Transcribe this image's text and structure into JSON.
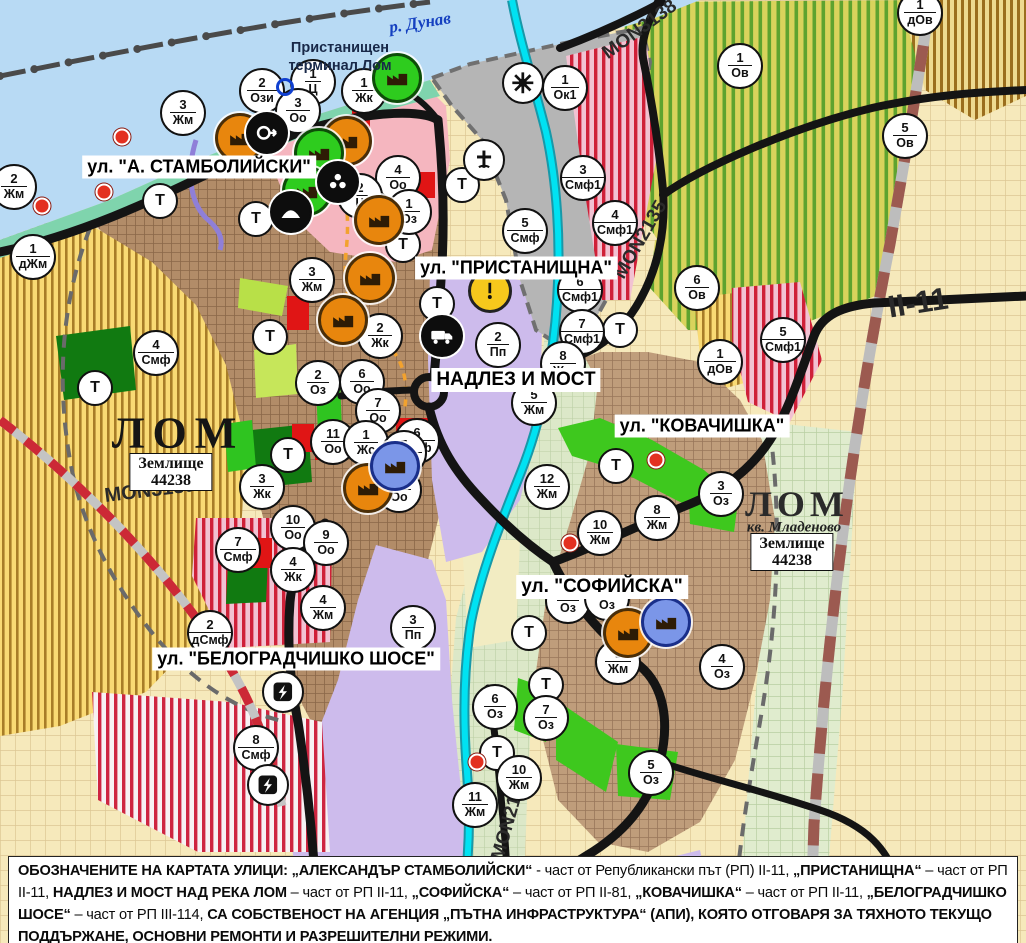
{
  "map": {
    "width": 1026,
    "height": 943,
    "colors": {
      "water": "#b8daf4",
      "shore": "#7fd4ad",
      "port_gray": "#b5b5b5",
      "urban_west": "#b28c68",
      "urban_east": "#bf9d7b",
      "pink_center": "#f5b6bf",
      "purple_zone": "#cdbbec",
      "yellow_farm": "#f9da74",
      "olive_orchard": "#d9d35c",
      "red_stripe": "#ce2540",
      "bright_green": "#3ec81e",
      "dark_green": "#117a11",
      "river_lom": "#00e2f2",
      "road_black": "#141414",
      "red_dash_road": "#cc2936",
      "brown_dash_road": "#9c5a50",
      "danube_label_blue": "#1540c0"
    },
    "street_labels": [
      {
        "text": "ул. \"А. СТАМБОЛИЙСКИ\"",
        "x": 199,
        "y": 167,
        "size": 18
      },
      {
        "text": "ул. \"ПРИСТАНИЩНА\"",
        "x": 516,
        "y": 268,
        "size": 18
      },
      {
        "text": "НАДЛЕЗ И МОСТ",
        "x": 516,
        "y": 380,
        "size": 19
      },
      {
        "text": "ул. \"КОВАЧИШКА\"",
        "x": 702,
        "y": 426,
        "size": 18
      },
      {
        "text": "ул. \"СОФИЙСКА\"",
        "x": 602,
        "y": 587,
        "size": 19
      },
      {
        "text": "ул. \"БЕЛОГРАДЧИШКО ШОСЕ\"",
        "x": 296,
        "y": 659,
        "size": 18
      }
    ],
    "road_labels": [
      {
        "text": "MON3138",
        "x": 640,
        "y": 30,
        "rot": -36,
        "size": 19
      },
      {
        "text": "MON2135",
        "x": 641,
        "y": 240,
        "rot": -60,
        "size": 19
      },
      {
        "text": "MON3139",
        "x": 150,
        "y": 491,
        "rot": -7,
        "size": 20
      },
      {
        "text": "MON2136",
        "x": 510,
        "y": 818,
        "rot": -74,
        "size": 19
      },
      {
        "text": "II-11",
        "x": 918,
        "y": 303,
        "rot": -9,
        "size": 31
      }
    ],
    "place_labels": {
      "danube": {
        "text": "р. Дунав"
      },
      "terminal": {
        "line1": "Пристанищен",
        "line2": "терминал Лом"
      },
      "lom_west": {
        "text": "ЛОМ"
      },
      "lom_east": {
        "text": "ЛОМ"
      },
      "mladenovo": {
        "text": "кв. Младеново"
      },
      "zemlishte_west": {
        "line1": "Землище",
        "line2": "44238"
      },
      "zemlishte_east": {
        "line1": "Землище",
        "line2": "44238"
      }
    },
    "t_label": "Т",
    "zone_markers": [
      {
        "n": "2",
        "c": "Жм",
        "x": 14,
        "y": 187
      },
      {
        "n": "3",
        "c": "Жм",
        "x": 183,
        "y": 113
      },
      {
        "n": "2",
        "c": "Ози",
        "x": 262,
        "y": 91
      },
      {
        "n": "1",
        "c": "Ц",
        "x": 313,
        "y": 82
      },
      {
        "n": "3",
        "c": "Оо",
        "x": 298,
        "y": 111
      },
      {
        "n": "1",
        "c": "Жк",
        "x": 364,
        "y": 91
      },
      {
        "n": "4",
        "c": "Оо",
        "x": 398,
        "y": 178
      },
      {
        "n": "2",
        "c": "Ц",
        "x": 360,
        "y": 196
      },
      {
        "n": "1",
        "c": "Оз",
        "x": 409,
        "y": 212
      },
      {
        "n": "1",
        "c": "Ок1",
        "x": 565,
        "y": 88
      },
      {
        "n": "1",
        "c": "дОв",
        "x": 920,
        "y": 13
      },
      {
        "n": "1",
        "c": "Ов",
        "x": 740,
        "y": 66
      },
      {
        "n": "5",
        "c": "Ов",
        "x": 905,
        "y": 136
      },
      {
        "n": "3",
        "c": "Смф1",
        "x": 583,
        "y": 178
      },
      {
        "n": "4",
        "c": "Смф1",
        "x": 615,
        "y": 223
      },
      {
        "n": "5",
        "c": "Смф",
        "x": 525,
        "y": 231
      },
      {
        "n": "6",
        "c": "Смф1",
        "x": 580,
        "y": 290
      },
      {
        "n": "7",
        "c": "Смф1",
        "x": 582,
        "y": 332
      },
      {
        "n": "2",
        "c": "Пп",
        "x": 498,
        "y": 345
      },
      {
        "n": "8",
        "c": "Жм",
        "x": 563,
        "y": 364
      },
      {
        "n": "5",
        "c": "Жм",
        "x": 534,
        "y": 403
      },
      {
        "n": "6",
        "c": "Ов",
        "x": 697,
        "y": 288
      },
      {
        "n": "1",
        "c": "дОв",
        "x": 720,
        "y": 362
      },
      {
        "n": "5",
        "c": "Смф1",
        "x": 783,
        "y": 340
      },
      {
        "n": "3",
        "c": "Оз",
        "x": 721,
        "y": 494
      },
      {
        "n": "8",
        "c": "Жм",
        "x": 657,
        "y": 518
      },
      {
        "n": "12",
        "c": "Жм",
        "x": 547,
        "y": 487
      },
      {
        "n": "10",
        "c": "Жм",
        "x": 600,
        "y": 533
      },
      {
        "n": "9",
        "c": "Жм",
        "x": 618,
        "y": 662
      },
      {
        "n": "4",
        "c": "Оз",
        "x": 722,
        "y": 667
      },
      {
        "n": "6",
        "c": "Оз",
        "x": 495,
        "y": 707
      },
      {
        "n": "7",
        "c": "Оз",
        "x": 546,
        "y": 718
      },
      {
        "n": "5",
        "c": "Оз",
        "x": 651,
        "y": 773
      },
      {
        "n": "10",
        "c": "Жм",
        "x": 519,
        "y": 778
      },
      {
        "n": "11",
        "c": "Жм",
        "x": 475,
        "y": 805
      },
      {
        "n": "8",
        "c": "Смф",
        "x": 256,
        "y": 748
      },
      {
        "n": "2",
        "c": "дСмф",
        "x": 210,
        "y": 633
      },
      {
        "n": "7",
        "c": "Смф",
        "x": 238,
        "y": 550
      },
      {
        "n": "10",
        "c": "Оо",
        "x": 293,
        "y": 528
      },
      {
        "n": "9",
        "c": "Оо",
        "x": 326,
        "y": 543
      },
      {
        "n": "4",
        "c": "Жк",
        "x": 293,
        "y": 570
      },
      {
        "n": "4",
        "c": "Жм",
        "x": 323,
        "y": 608
      },
      {
        "n": "3",
        "c": "Пп",
        "x": 413,
        "y": 628
      },
      {
        "n": "3",
        "c": "Жм",
        "x": 312,
        "y": 280
      },
      {
        "n": "2",
        "c": "Жк",
        "x": 380,
        "y": 336
      },
      {
        "n": "6",
        "c": "Оо",
        "x": 362,
        "y": 382
      },
      {
        "n": "7",
        "c": "Оо",
        "x": 378,
        "y": 411
      },
      {
        "n": "2",
        "c": "Оз",
        "x": 318,
        "y": 383
      },
      {
        "n": "11",
        "c": "Оо",
        "x": 333,
        "y": 442
      },
      {
        "n": "1",
        "c": "Жс",
        "x": 366,
        "y": 443
      },
      {
        "n": "6",
        "c": "Смф",
        "x": 417,
        "y": 441
      },
      {
        "n": "5",
        "c": "Смф",
        "x": 404,
        "y": 453
      },
      {
        "n": "8",
        "c": "Оо",
        "x": 399,
        "y": 490
      },
      {
        "n": "3",
        "c": "Жк",
        "x": 262,
        "y": 487
      },
      {
        "n": "1",
        "c": "дЖм",
        "x": 33,
        "y": 257
      },
      {
        "n": "4",
        "c": "Смф",
        "x": 156,
        "y": 353
      },
      {
        "n": "",
        "c": "Оз",
        "x": 568,
        "y": 601
      },
      {
        "n": "",
        "c": "Оз",
        "x": 607,
        "y": 598
      }
    ],
    "t_markers": [
      {
        "x": 160,
        "y": 201
      },
      {
        "x": 256,
        "y": 219
      },
      {
        "x": 270,
        "y": 337
      },
      {
        "x": 95,
        "y": 388
      },
      {
        "x": 288,
        "y": 455
      },
      {
        "x": 462,
        "y": 185
      },
      {
        "x": 403,
        "y": 245
      },
      {
        "x": 437,
        "y": 304
      },
      {
        "x": 620,
        "y": 330
      },
      {
        "x": 616,
        "y": 466
      },
      {
        "x": 529,
        "y": 633
      },
      {
        "x": 546,
        "y": 685
      },
      {
        "x": 497,
        "y": 753
      }
    ],
    "icon_markers": [
      {
        "type": "factory-orange",
        "x": 240,
        "y": 138
      },
      {
        "type": "factory-orange",
        "x": 347,
        "y": 141
      },
      {
        "type": "factory-orange",
        "x": 379,
        "y": 220
      },
      {
        "type": "factory-orange",
        "x": 370,
        "y": 278
      },
      {
        "type": "factory-orange",
        "x": 343,
        "y": 320
      },
      {
        "type": "factory-orange",
        "x": 368,
        "y": 488
      },
      {
        "type": "factory-orange",
        "x": 628,
        "y": 633
      },
      {
        "type": "factory-green",
        "x": 319,
        "y": 153
      },
      {
        "type": "factory-green",
        "x": 397,
        "y": 78
      },
      {
        "type": "factory-green",
        "x": 307,
        "y": 191
      },
      {
        "type": "factory-blue",
        "x": 395,
        "y": 466
      },
      {
        "type": "factory-blue",
        "x": 666,
        "y": 622
      },
      {
        "type": "arrow",
        "x": 267,
        "y": 133
      },
      {
        "type": "person",
        "x": 338,
        "y": 182
      },
      {
        "type": "chevron",
        "x": 291,
        "y": 212
      },
      {
        "type": "truck",
        "x": 442,
        "y": 336
      },
      {
        "type": "warning",
        "x": 490,
        "y": 291
      },
      {
        "type": "cross",
        "x": 484,
        "y": 160
      },
      {
        "type": "sun",
        "x": 523,
        "y": 83
      },
      {
        "type": "lightning",
        "x": 283,
        "y": 692
      },
      {
        "type": "lightning",
        "x": 268,
        "y": 785
      },
      {
        "type": "blue-ring",
        "x": 285,
        "y": 87
      },
      {
        "type": "red-dot",
        "x": 122,
        "y": 137
      },
      {
        "type": "red-dot",
        "x": 104,
        "y": 192
      },
      {
        "type": "red-dot",
        "x": 42,
        "y": 206
      },
      {
        "type": "red-dot",
        "x": 656,
        "y": 460
      },
      {
        "type": "red-dot",
        "x": 570,
        "y": 543
      },
      {
        "type": "red-dot",
        "x": 477,
        "y": 762
      }
    ]
  },
  "footer": {
    "segments": [
      {
        "text": "ОБОЗНАЧЕНИТЕ НА КАРТАТА УЛИЦИ: „АЛЕКСАНДЪР СТАМБОЛИЙСКИ“",
        "bold": true
      },
      {
        "text": " - част от Републикански път (РП) II-11, ",
        "bold": false
      },
      {
        "text": "„ПРИСТАНИЩНА“",
        "bold": true
      },
      {
        "text": " – част от РП II-11, ",
        "bold": false
      },
      {
        "text": "НАДЛЕЗ И МОСТ НАД РЕКА ЛОМ",
        "bold": true
      },
      {
        "text": " – част от РП II-11, ",
        "bold": false
      },
      {
        "text": "„СОФИЙСКА“",
        "bold": true
      },
      {
        "text": " – част от РП II-81, ",
        "bold": false
      },
      {
        "text": "„КОВАЧИШКА“",
        "bold": true
      },
      {
        "text": " – част от РП II-11, ",
        "bold": false
      },
      {
        "text": "„БЕЛОГРАДЧИШКО ШОСЕ“",
        "bold": true
      },
      {
        "text": " – част от РП III-114, ",
        "bold": false
      },
      {
        "text": "СА СОБСТВЕНОСТ НА АГЕНЦИЯ „ПЪТНА ИНФРАСТРУКТУРА“ (АПИ), КОЯТО ОТГОВАРЯ ЗА ТЯХНОТО ТЕКУЩО ПОДДЪРЖАНЕ, ОСНОВНИ РЕМОНТИ И РАЗРЕШИТЕЛНИ РЕЖИМИ.",
        "bold": true
      }
    ]
  }
}
